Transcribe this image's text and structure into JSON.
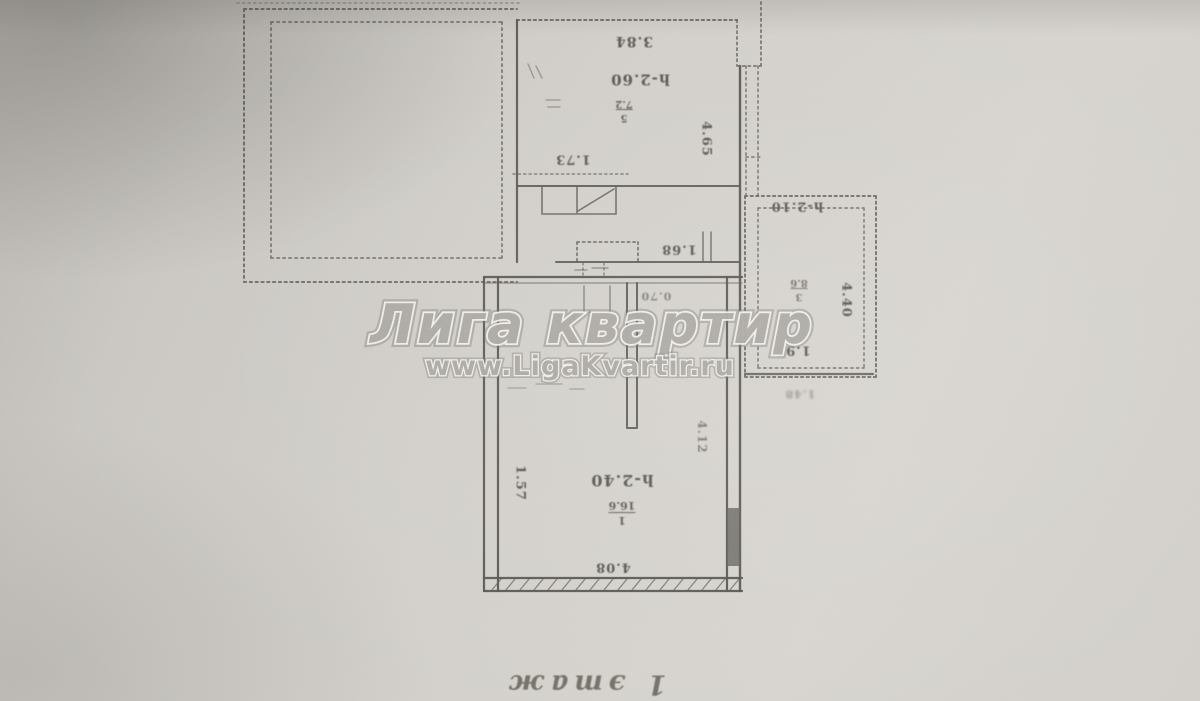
{
  "watermark": {
    "title": "Лига квартир",
    "url": "www.LigaKvartir.ru"
  },
  "caption": {
    "floor": "1 этаж"
  },
  "labels": {
    "top_room_width": "3.84",
    "top_room_height": "h-2.60",
    "top_room_number": "5",
    "top_room_area": "7.2",
    "porch_width": "1.73",
    "hall_width": "1.68",
    "top_room_depth": "4.65",
    "right_room_height": "h-2.10",
    "right_room_depth": "4.40",
    "right_room_width": "1.95",
    "right_room_number": "3",
    "right_room_area": "8.6",
    "right_room_note": "1.48",
    "door_width": "0.70",
    "main_room_height": "h-2.40",
    "main_room_number": "1",
    "main_room_area": "16.6",
    "main_room_width": "4.08",
    "main_room_left": "1.57",
    "main_room_right": "4.12"
  },
  "colors": {
    "paper": "#d2cfca",
    "ink": "#514f49",
    "watermark_fill": "#a9a6a0"
  }
}
